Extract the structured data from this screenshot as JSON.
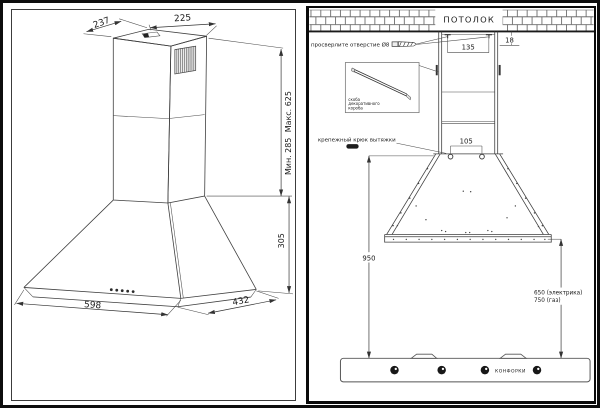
{
  "colors": {
    "line": "#3f3f3f",
    "text": "#1a1a1a"
  },
  "left": {
    "dim_chimney_depth": "237",
    "dim_chimney_width": "225",
    "dim_height_max": "Макс. 625",
    "dim_height_min": "Мин. 285",
    "dim_hood_height": "305",
    "dim_hood_width": "598",
    "dim_hood_depth": "432"
  },
  "right": {
    "ceiling": "ПОТОЛОК",
    "drill_note": "просверлите отверстие Ø8",
    "dim_screw_spacing": "135",
    "dim_wall_offset": "18",
    "bracket_caption": [
      "скоба",
      "декоративного",
      "короба"
    ],
    "hook_note": "крепежный крюк вытяжки",
    "dim_hook_spacing": "105",
    "dim_mount_height": "950",
    "dim_clearance_electric": "650 (электрика)",
    "dim_clearance_gas": "750 (газ)",
    "burners": "КОНФОРКИ"
  }
}
